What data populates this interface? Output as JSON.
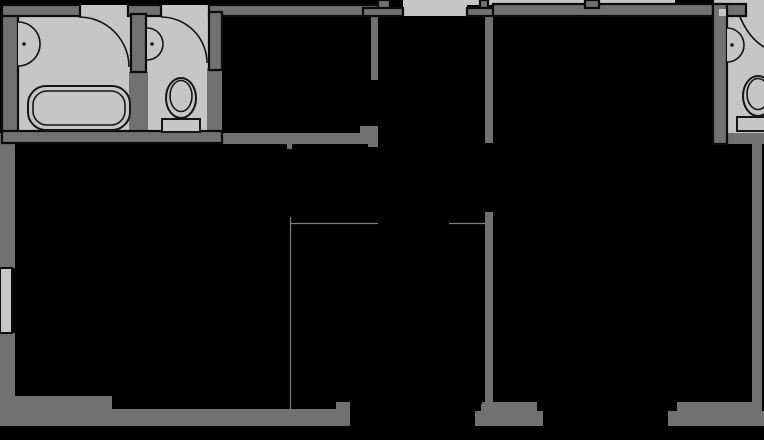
{
  "meta": {
    "title": "Apartment floor plan (black-and-white architectural drawing)",
    "drawing_type": "floor-plan",
    "no_visible_text": true
  },
  "palette": {
    "background": "#000000",
    "wall": "#717171",
    "wall_outline": "#0b0b0b",
    "floor": "#c6c6c6",
    "fixture_line": "#161616",
    "fixture_fill": "#c6c6c6",
    "thin_line": "#7e7e7e",
    "dot": "#1a1a1a"
  },
  "regions": {
    "left_bathroom": "bathroom with bathtub, wash basin and door swing (top left)",
    "wc": "small toilet room with basin and door swing (top, second from left)",
    "middle_room": "unfilled room (top middle)",
    "entry_hall": "hall with entrance opening at top center",
    "living_room": "large unfilled room (top right)",
    "right_bathroom": "bathroom with basin and toilet (top right corner, cropped)",
    "bedroom_left": "large unfilled room (bottom left)",
    "open_area": "open-plan area outlined with thin lines (bottom center)",
    "bedroom_right": "large unfilled room (bottom right)"
  },
  "fixtures": [
    "bathtub",
    "wash-basin-left-bathroom",
    "door-swing-left-bathroom",
    "toilet-wc",
    "wash-basin-wc",
    "door-swing-wc",
    "wash-basin-right-bathroom",
    "toilet-right-bathroom",
    "door-swing-right-bathroom"
  ]
}
